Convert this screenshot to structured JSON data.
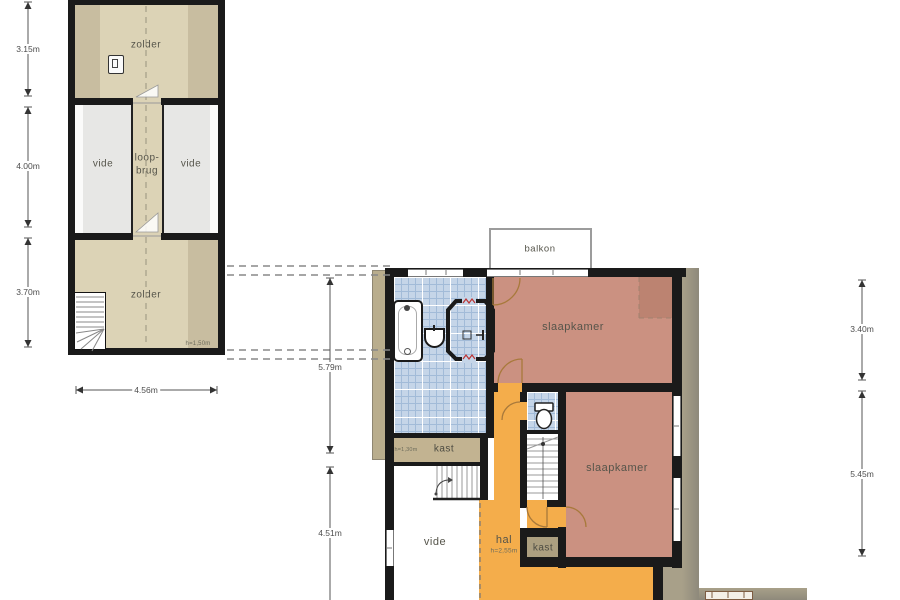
{
  "attic_plan": {
    "rooms": {
      "zolder_top": "zolder",
      "vide_left": "vide",
      "loopbrug_line1": "loop-",
      "loopbrug_line2": "brug",
      "vide_right": "vide",
      "zolder_bottom": "zolder"
    },
    "height_note": "h=1,50m",
    "dimensions": {
      "top_section": "3.15m",
      "middle_section": "4.00m",
      "bottom_section": "3.70m",
      "width": "4.56m"
    }
  },
  "floor_plan": {
    "rooms": {
      "balkon": "balkon",
      "slaapkamer_top": "slaapkamer",
      "slaapkamer_bottom": "slaapkamer",
      "kast_left": "kast",
      "kast_right": "kast",
      "vide": "vide",
      "hal": "hal"
    },
    "height_notes": {
      "kast_left": "h=1,30m",
      "hal": "h=2,55m"
    },
    "dimensions": {
      "left_top": "5.79m",
      "left_bottom": "4.51m",
      "right_top": "3.40m",
      "right_bottom": "5.45m"
    }
  },
  "colors": {
    "wall": "#1a1a1a",
    "attic_beige": "#dcd3b6",
    "attic_beige_dark": "#c8bda0",
    "vide_gray": "#e7e7e5",
    "bedroom_salmon": "#cb9181",
    "hall_orange": "#f4ad4b",
    "bathroom_tile": "#c5d5e8",
    "roof_edge_tan": "#b9ad8d",
    "closet_tan": "#c2b391",
    "shower_mark_red": "#bb3333"
  }
}
